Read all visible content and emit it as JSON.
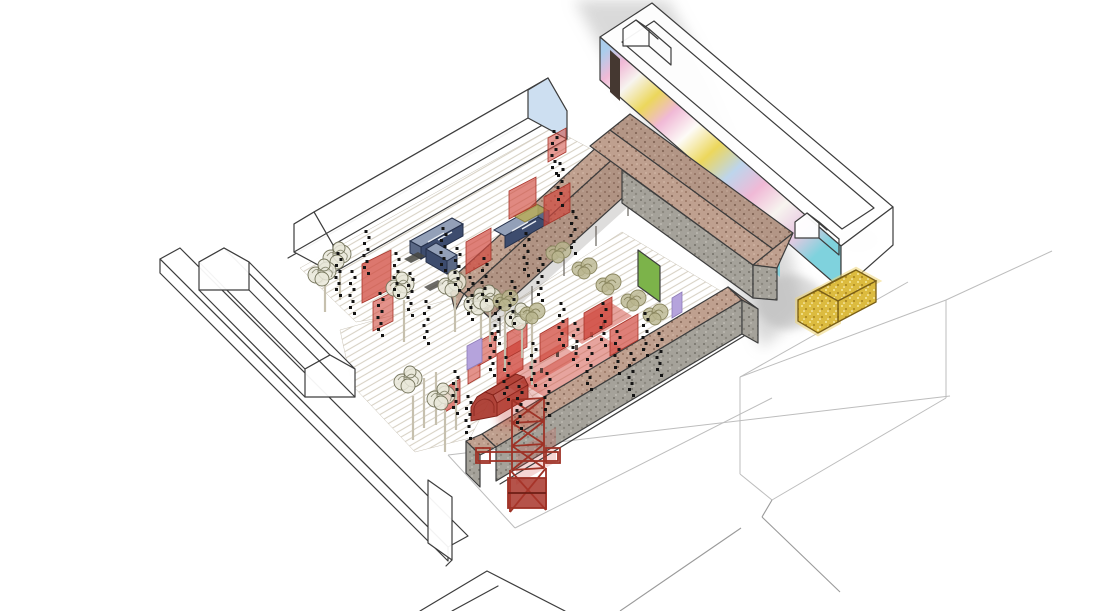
{
  "meta": {
    "type": "axonometric-architectural-illustration",
    "description": "Hand-drawn axonometric view of an urban block: white outline buildings around courtyards activated with red screens, blue containers, string lights, trees, a red lattice tower, a red vaulted kiosk, a glittering gold pavilion and a pastel mural wall."
  },
  "colors": {
    "background": "#ffffff",
    "ink_outline": "#3d3d3d",
    "faint_line": "#bdbdbd",
    "street_wash": "#ababab",
    "ground_hatch": "#d8d2c5",
    "roof_brown": "#bfa08f",
    "roof_brown_dark": "#a8887a",
    "concrete_wall": "#a19d95",
    "red_screen": "#d0493e",
    "red_structure": "#a8352a",
    "container_top": "#93a0b8",
    "container_side": "#3d4c6e",
    "container_end": "#5a6885",
    "gold_pavilion": "#dcbb3f",
    "gold_glow": "#eed677",
    "green_panel": "#7cb34a",
    "lavender_panel": "#b5a3dc",
    "tree_foliage": "#e9e7d9",
    "tree_line": "#75755c",
    "olive_foliage": "#b9b58e",
    "gable_blue": "#cddff1",
    "mural_blue": "#aacdec",
    "mural_pink": "#f0b9d6",
    "mural_yellow": "#ecd75c",
    "mural_cyan": "#7fd2dd",
    "mural_white": "#f7f4ef",
    "string_light": "#141414"
  },
  "scene": {
    "buildings": [
      {
        "name": "east-gallery-building",
        "note": "long white outline bar, pastel graffiti mural on street wall, dark door, two gabled roof boxes"
      },
      {
        "name": "north-hall-building",
        "note": "white outline gabled hall, light-blue far gable"
      },
      {
        "name": "west-gabled-building",
        "note": "white outline gabled bar"
      },
      {
        "name": "west-slab-building",
        "note": "long white outline flat bar with end block"
      },
      {
        "name": "central-wing-ne",
        "note": "brown pitched-roof wing with open colonnade"
      },
      {
        "name": "central-wing-cross",
        "note": "brown pitched-roof wing, concrete wall, bright green door"
      },
      {
        "name": "southeast-workshop",
        "note": "brown roof over tall textured concrete street wall"
      },
      {
        "name": "bottom-corner-building",
        "note": "partial dark outline at lower edge"
      }
    ],
    "courtyard_elements": [
      {
        "name": "ground-hatch",
        "note": "fine diagonal hatched paving"
      },
      {
        "name": "blue-containers",
        "note": "L-shaped container group plus single container"
      },
      {
        "name": "red-screens",
        "note": "translucent red standing panels"
      },
      {
        "name": "red-carpets",
        "note": "red painted ground patches with small figures"
      },
      {
        "name": "red-vault-pavilion",
        "note": "small red barrel-vault kiosk"
      },
      {
        "name": "red-lattice-tower",
        "note": "red headframe-style lattice tower"
      },
      {
        "name": "gold-pavilion",
        "note": "glittering gold kiosk on the street corner"
      },
      {
        "name": "string-lights",
        "note": "hanging strings of black festoon bulbs"
      },
      {
        "name": "trees",
        "note": "sketchy deciduous trees with pale trunks"
      },
      {
        "name": "green-panel",
        "note": "green door panel"
      },
      {
        "name": "lavender-panels",
        "note": "small purple screens"
      },
      {
        "name": "street-wash",
        "note": "grey watercolour street between blocks"
      },
      {
        "name": "site-lines",
        "note": "faint plot and street guide lines"
      }
    ]
  }
}
